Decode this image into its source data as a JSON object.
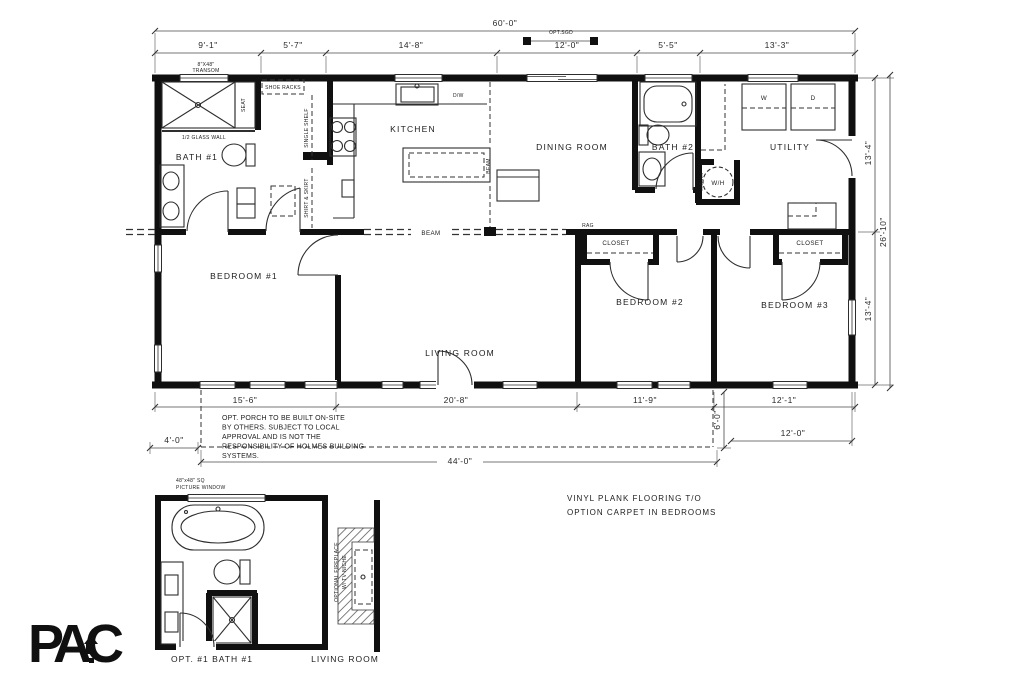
{
  "colors": {
    "ink": "#101010",
    "line": "#2e2e2e",
    "dim": "#4a4a4a"
  },
  "dims": {
    "top_overall": "60'-0\"",
    "top_segments": [
      "9'-1\"",
      "5'-7\"",
      "14'-8\"",
      "12'-0\"",
      "5'-5\"",
      "13'-3\""
    ],
    "opt_sgd": "OPT.SGD",
    "right_top": "13'-4\"",
    "right_overall": "26'-10\"",
    "right_bottom": "13'-4\"",
    "bottom_segments": [
      "15'-6\"",
      "20'-8\"",
      "11'-9\"",
      "12'-1\""
    ],
    "porch_depth": "4'-0\"",
    "patio_depth": "6'-0\"",
    "patio_width": "12'-0\"",
    "porch_width": "44'-0\""
  },
  "rooms": {
    "bath1": "BATH  #1",
    "kitchen": "KITCHEN",
    "dining": "DINING  ROOM",
    "bath2": "BATH  #2",
    "utility": "UTILITY",
    "bedroom1": "BEDROOM  #1",
    "bedroom2": "BEDROOM  #2",
    "bedroom3": "BEDROOM  #3",
    "living": "LIVING  ROOM",
    "closet": "CLOSET"
  },
  "labels": {
    "transom1": "8\"X48\"",
    "transom2": "TRANSOM",
    "glass_wall": "1/2 GLASS WALL",
    "seat": "SEAT",
    "shoe_racks": "SHOE RACKS",
    "single_shelf": "SINGLE SHELF",
    "shirt_skirt": "SHIRT & SKIRT",
    "dw": "D/W",
    "beam": "BEAM",
    "rag": "RAG",
    "washer": "W",
    "dryer": "D",
    "water_heater": "W/H",
    "shelves": "SHELVES"
  },
  "notes": {
    "porch": [
      "OPT. PORCH TO BE BUILT ON-SITE",
      "BY OTHERS. SUBJECT TO LOCAL",
      "APPROVAL AND IS NOT THE",
      "RESPONSIBILITY OF HOLMES BUILDING",
      "SYSTEMS."
    ],
    "flooring": [
      "VINYL PLANK FLOORING T/O",
      "OPTION CARPET IN BEDROOMS"
    ]
  },
  "details": {
    "opt_bath": {
      "window1": "48\"x48\" SQ",
      "window2": "PICTURE WINDOW",
      "caption": "OPT.  #1 BATH  #1"
    },
    "fireplace": {
      "label1": "OPTIONAL FIREPLACE",
      "label2": "W/ TV NICHE",
      "caption": "LIVING  ROOM"
    }
  },
  "logo": {
    "text": "PAC"
  }
}
